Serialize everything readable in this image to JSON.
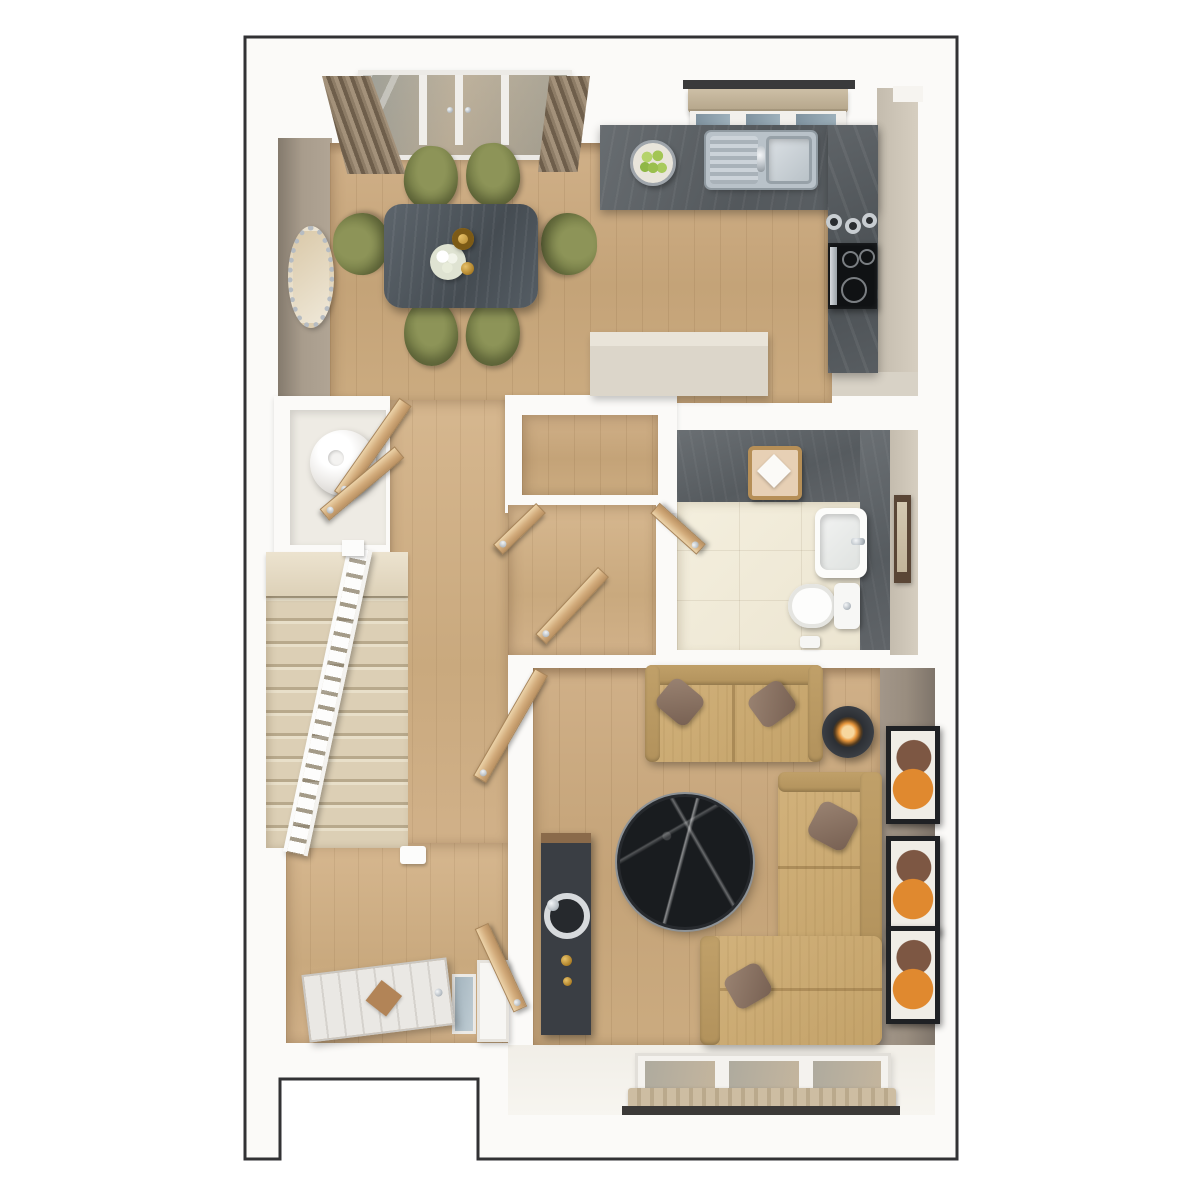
{
  "meta": {
    "type": "3d-top-down-floor-plan-render",
    "canvas_width": 1200,
    "canvas_height": 1200,
    "visible_text": "none"
  },
  "palette": {
    "outline": "#323234",
    "wall_white": "#fbfaf8",
    "wood_floor": "#c9aa7f",
    "carpet_stairs": "#dccfb5",
    "tile_cream": "#f0ead9",
    "feature_dark_gray": "#5b6064",
    "taupe_wall": "#a2968a",
    "beige_wall": "#d0c8ba",
    "sofa_tan": "#c9a873",
    "pillow_brown": "#8a7263",
    "chair_olive": "#7e8551",
    "table_dark_wood": "#525a61",
    "marble_black": "#1b1e21",
    "door_wood": "#d8b488",
    "curtain_brown": "#8a7a67",
    "glass_blue": "#8aa2b2",
    "blind_tan": "#c3b49b",
    "art_orange": "#e0892f",
    "gold_accent": "#b98a2e"
  },
  "rooms": [
    {
      "name": "dining-area",
      "floor": "wood"
    },
    {
      "name": "kitchen",
      "floor": "wood"
    },
    {
      "name": "hallway",
      "floor": "wood"
    },
    {
      "name": "staircase",
      "floor": "carpet",
      "banister": "white"
    },
    {
      "name": "airing-cupboard",
      "contents": "water-cylinder"
    },
    {
      "name": "storage-cupboard",
      "floor": "wood"
    },
    {
      "name": "bathroom",
      "floor": "cream-tile",
      "feature_walls": "dark-gray"
    },
    {
      "name": "living-room",
      "floor": "wood",
      "feature_wall": "taupe"
    },
    {
      "name": "entrance-hall",
      "floor": "wood"
    }
  ],
  "furniture": {
    "dining": [
      "dining-table",
      "dining-chairs x6",
      "floral-centerpiece",
      "gold-vase",
      "wall-mirror",
      "curtains x2",
      "french-doors"
    ],
    "kitchen": [
      "l-shaped-counter",
      "double-sink",
      "fruit-bowl-green-apples",
      "hob-with-oven",
      "canisters x3",
      "window-with-blind",
      "peninsula-unit"
    ],
    "hall": [
      "water-cylinder",
      "staircase-13-steps",
      "banister",
      "internal-doors x7",
      "front-door",
      "console"
    ],
    "bathroom": [
      "wash-basin",
      "toilet",
      "towel-rail",
      "storage-basket-with-towel"
    ],
    "living": [
      "two-seat-sofa",
      "l-shaped-sofa",
      "pillows x4",
      "round-marble-coffee-table",
      "candle-side-table",
      "media-unit-with-speaker",
      "wall-frames x3",
      "triple-pane-window"
    ]
  },
  "counts": {
    "dining_chairs": 6,
    "wall_frames": 3,
    "window_panes_bottom": 3,
    "stair_treads": 13
  }
}
